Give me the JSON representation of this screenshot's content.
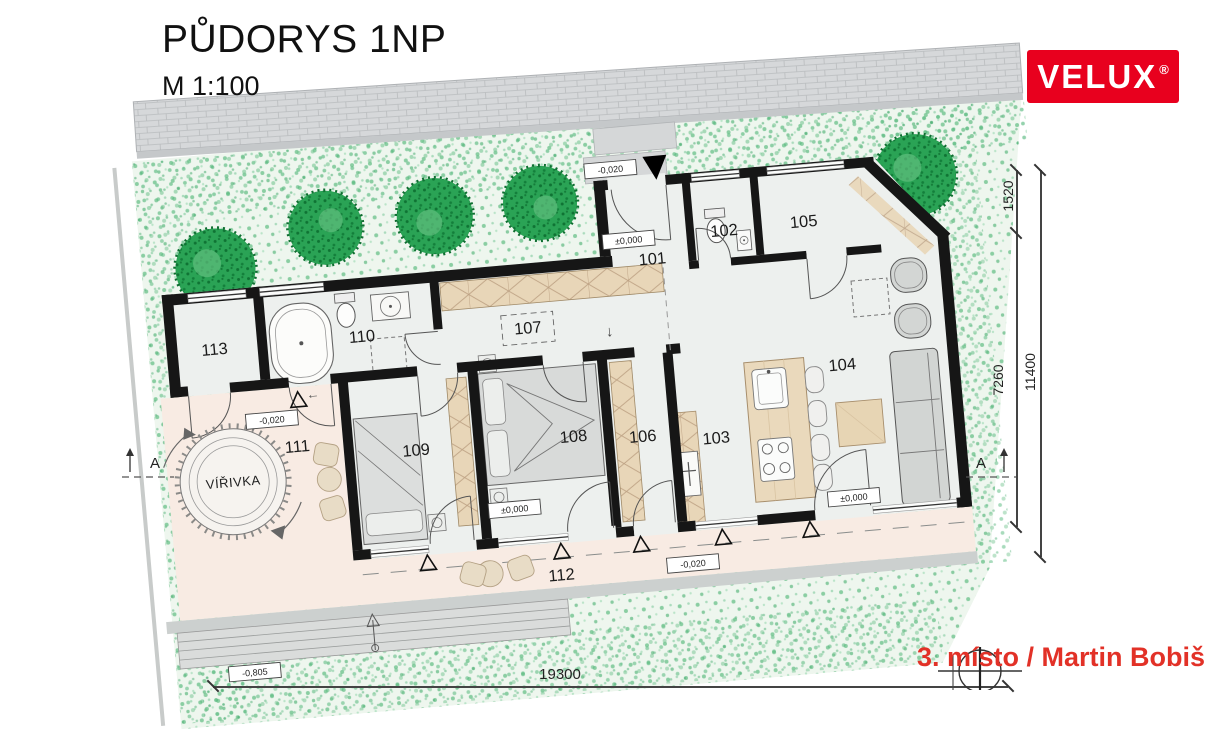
{
  "header": {
    "title": "PŮDORYS 1NP",
    "scale": "M 1:100"
  },
  "brand": {
    "name": "VELUX",
    "registered": "®"
  },
  "award": {
    "text": "3. místo / Martin Bobiš"
  },
  "rooms": {
    "r101": "101",
    "r102": "102",
    "r103": "103",
    "r104": "104",
    "r105": "105",
    "r106": "106",
    "r107": "107",
    "r108": "108",
    "r109": "109",
    "r110": "110",
    "r111": "111",
    "r112": "112",
    "r113": "113"
  },
  "features": {
    "spa": "VÍŘIVKA",
    "hall_arrow": "↓",
    "terrace_arrow": "←"
  },
  "levels": {
    "zero": "±0,000",
    "minus_020": "-0,020",
    "minus_805": "-0,805"
  },
  "dimensions": {
    "right_top": "1520",
    "right_inner": "7260",
    "right_total": "11400",
    "bottom_total": "19300"
  },
  "section": {
    "label": "A"
  },
  "colors": {
    "brand_red": "#e8001e",
    "award_red": "#e23127",
    "wall": "#161616",
    "terrace": "#f8ebe3",
    "floor": "#edf0ee",
    "wood": "#e8d6b8",
    "garden_dot": "#79c795",
    "street": "#d6d8da"
  }
}
